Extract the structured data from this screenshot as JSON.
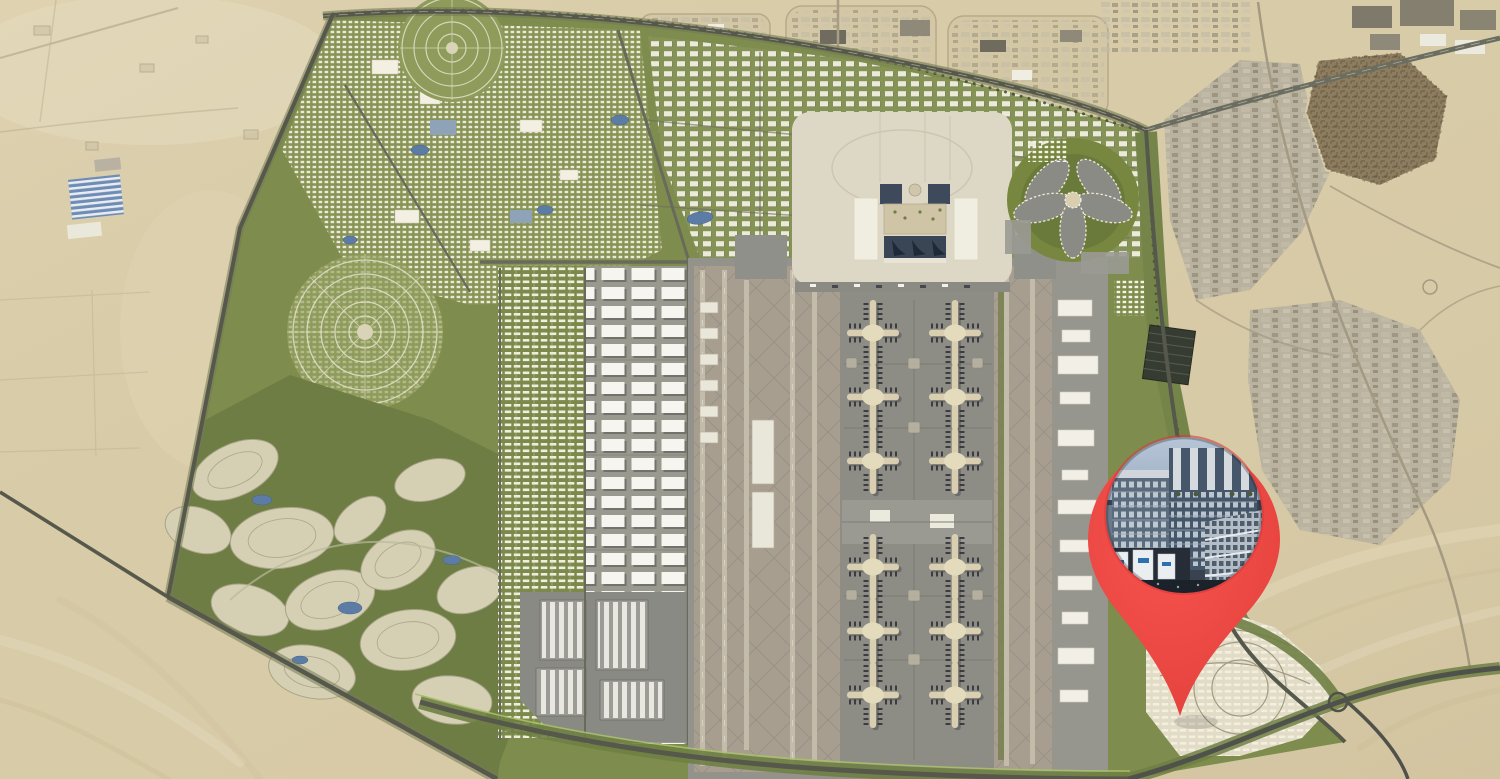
{
  "map": {
    "kind": "masterplan-aerial",
    "marker": {
      "icon": "location-pin-icon",
      "photo": "apartment-building-photo"
    }
  },
  "colors": {
    "desert_base": "#d8cba7",
    "desert_light": "#e7ddc1",
    "desert_dark": "#c6b793",
    "satellite_gray": "#b7b09e",
    "satellite_road": "#a49a82",
    "maze_brown": "#8d7c5e",
    "plan_green": "#7e8d4e",
    "plan_green_light": "#879455",
    "plan_green_dark": "#5f7036",
    "golf_green": "#6d7d43",
    "cluster_cream": "#d5d0b4",
    "building_white": "#f6f3e7",
    "airport_gray": "#93938c",
    "apron_gray": "#8d8d86",
    "runway_tan": "#a79e90",
    "runway_strip": "#c3bcab",
    "concourse_cream": "#d9cfb0",
    "aircraft_dark": "#34353a",
    "terminal_beige": "#ddd7c5",
    "terminal_blue": "#3e4a5c",
    "road_dark": "#55584b",
    "water_blue": "#5c7ca6",
    "community_cream": "#e2dcc6",
    "pin_red": "#f8554f",
    "pin_red_dark": "#e03c39",
    "photo_sky_top": "#b7c5d6",
    "photo_sky_bottom": "#8da2b8",
    "photo_building_dark": "#47576b",
    "photo_building_mid": "#5b6b7e",
    "photo_building_light": "#b4bec8",
    "photo_podium": "#262d36",
    "banner_white": "#eaeef1"
  }
}
